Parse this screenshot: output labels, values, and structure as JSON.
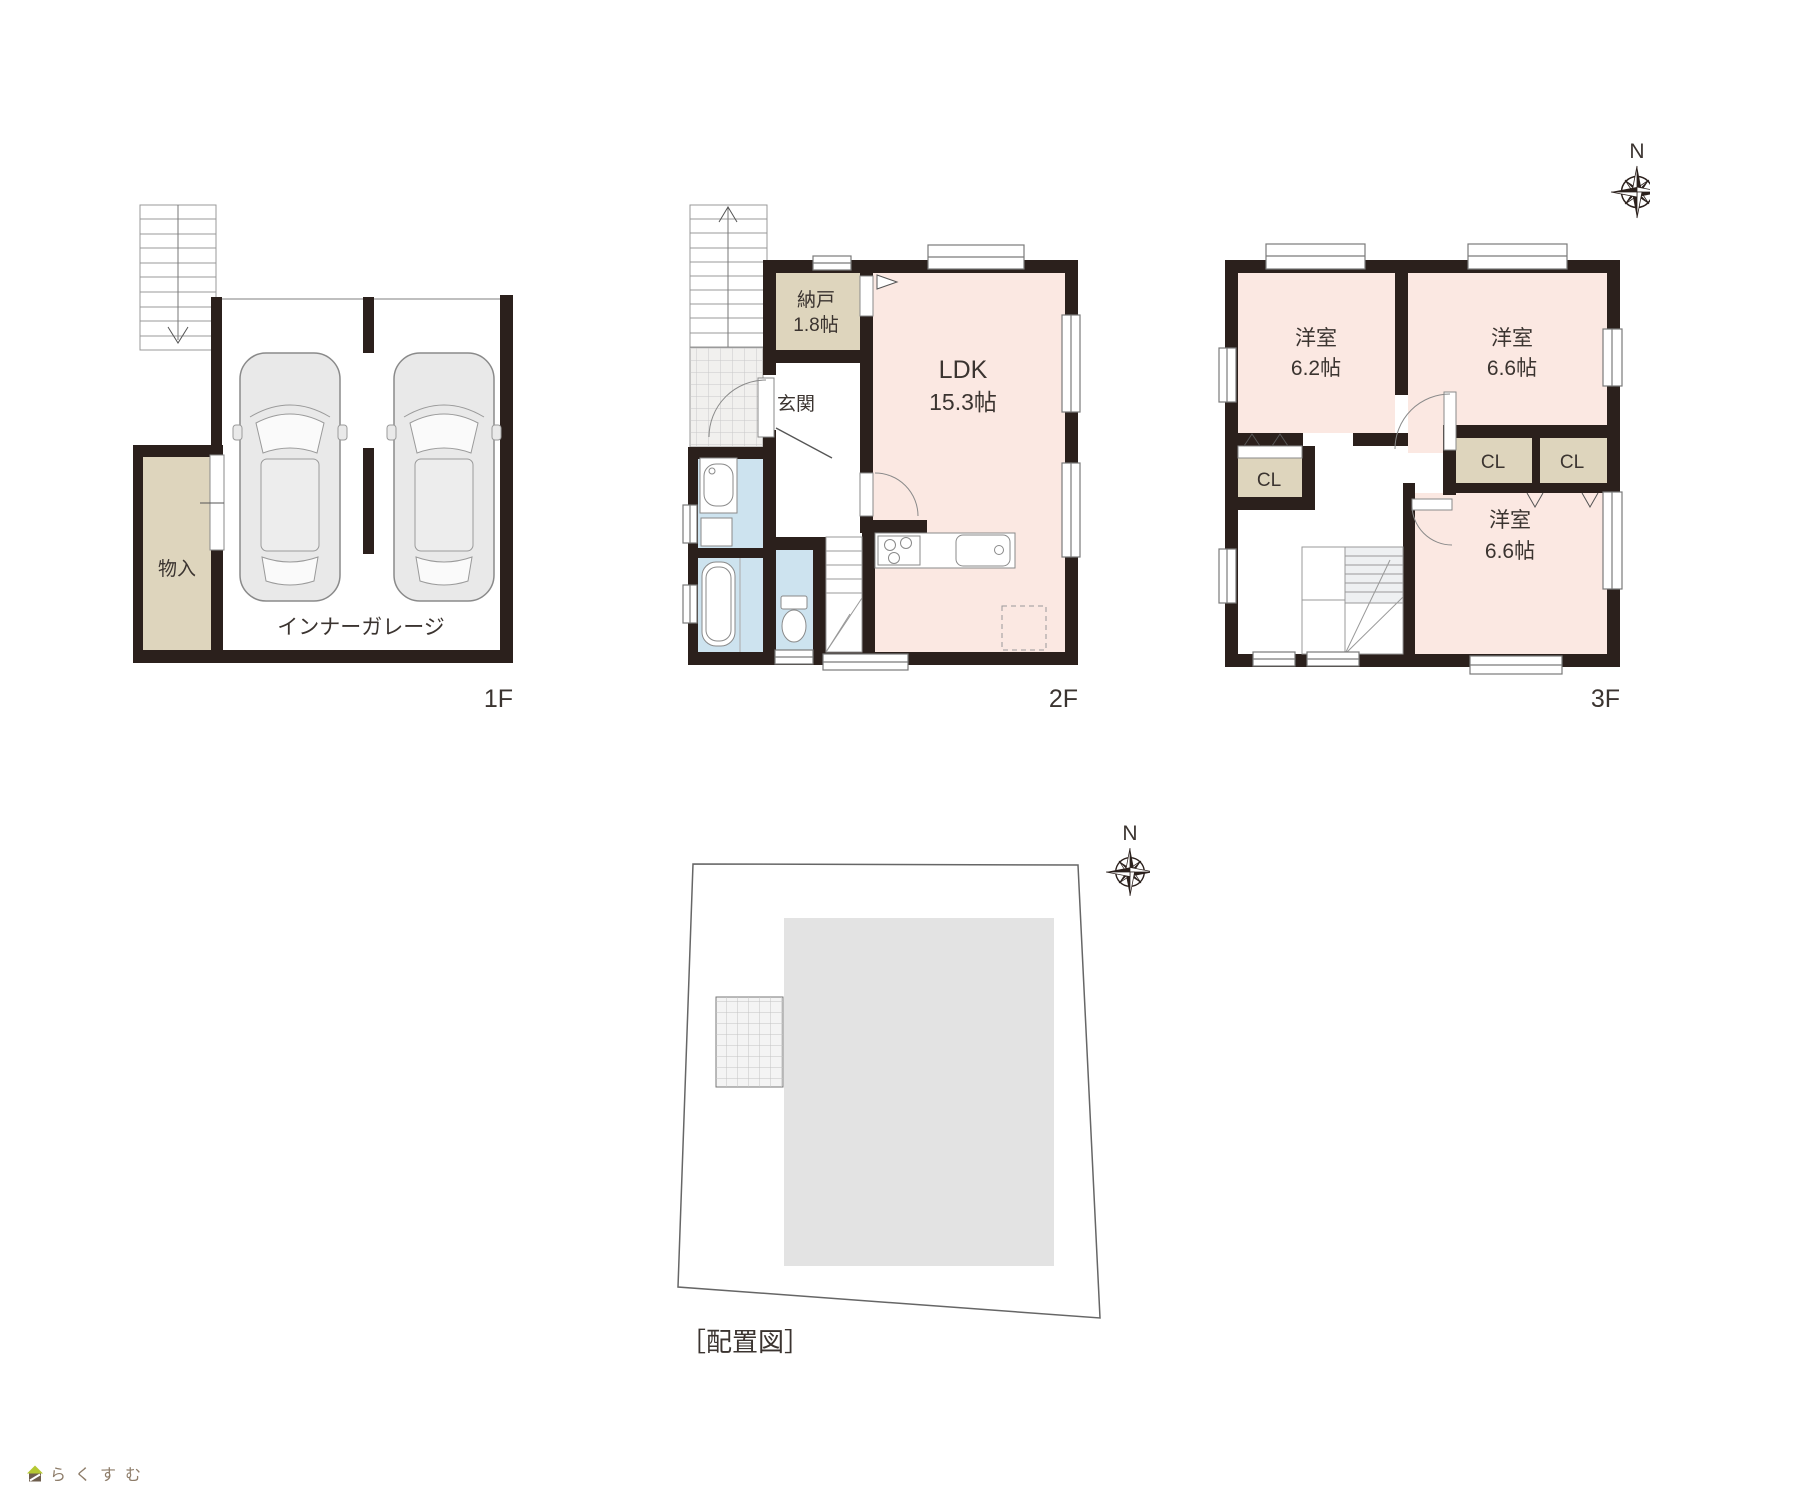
{
  "compass": {
    "n": "N"
  },
  "floor1": {
    "label": "1F",
    "storage": "物入",
    "garage": "インナーガレージ"
  },
  "floor2": {
    "label": "2F",
    "nando": "納戸",
    "nando_size": "1.8帖",
    "genkan": "玄関",
    "ldk": "LDK",
    "ldk_size": "15.3帖"
  },
  "floor3": {
    "label": "3F",
    "room_nw": "洋室",
    "room_nw_size": "6.2帖",
    "room_ne": "洋室",
    "room_ne_size": "6.6帖",
    "room_se": "洋室",
    "room_se_size": "6.6帖",
    "closet_w": "CL",
    "closet_m": "CL",
    "closet_e": "CL"
  },
  "site": {
    "label": "［配置図］"
  },
  "logo": {
    "brand": "らくすむ"
  },
  "colors": {
    "wall": "#2b201c",
    "room_pink": "#fbe8e2",
    "room_beige": "#ded5bd",
    "room_blue": "#cde3ef",
    "site_building": "#e3e3e3",
    "logo_roof_green": "#b5c832",
    "logo_body_brown": "#6e5e4d"
  }
}
